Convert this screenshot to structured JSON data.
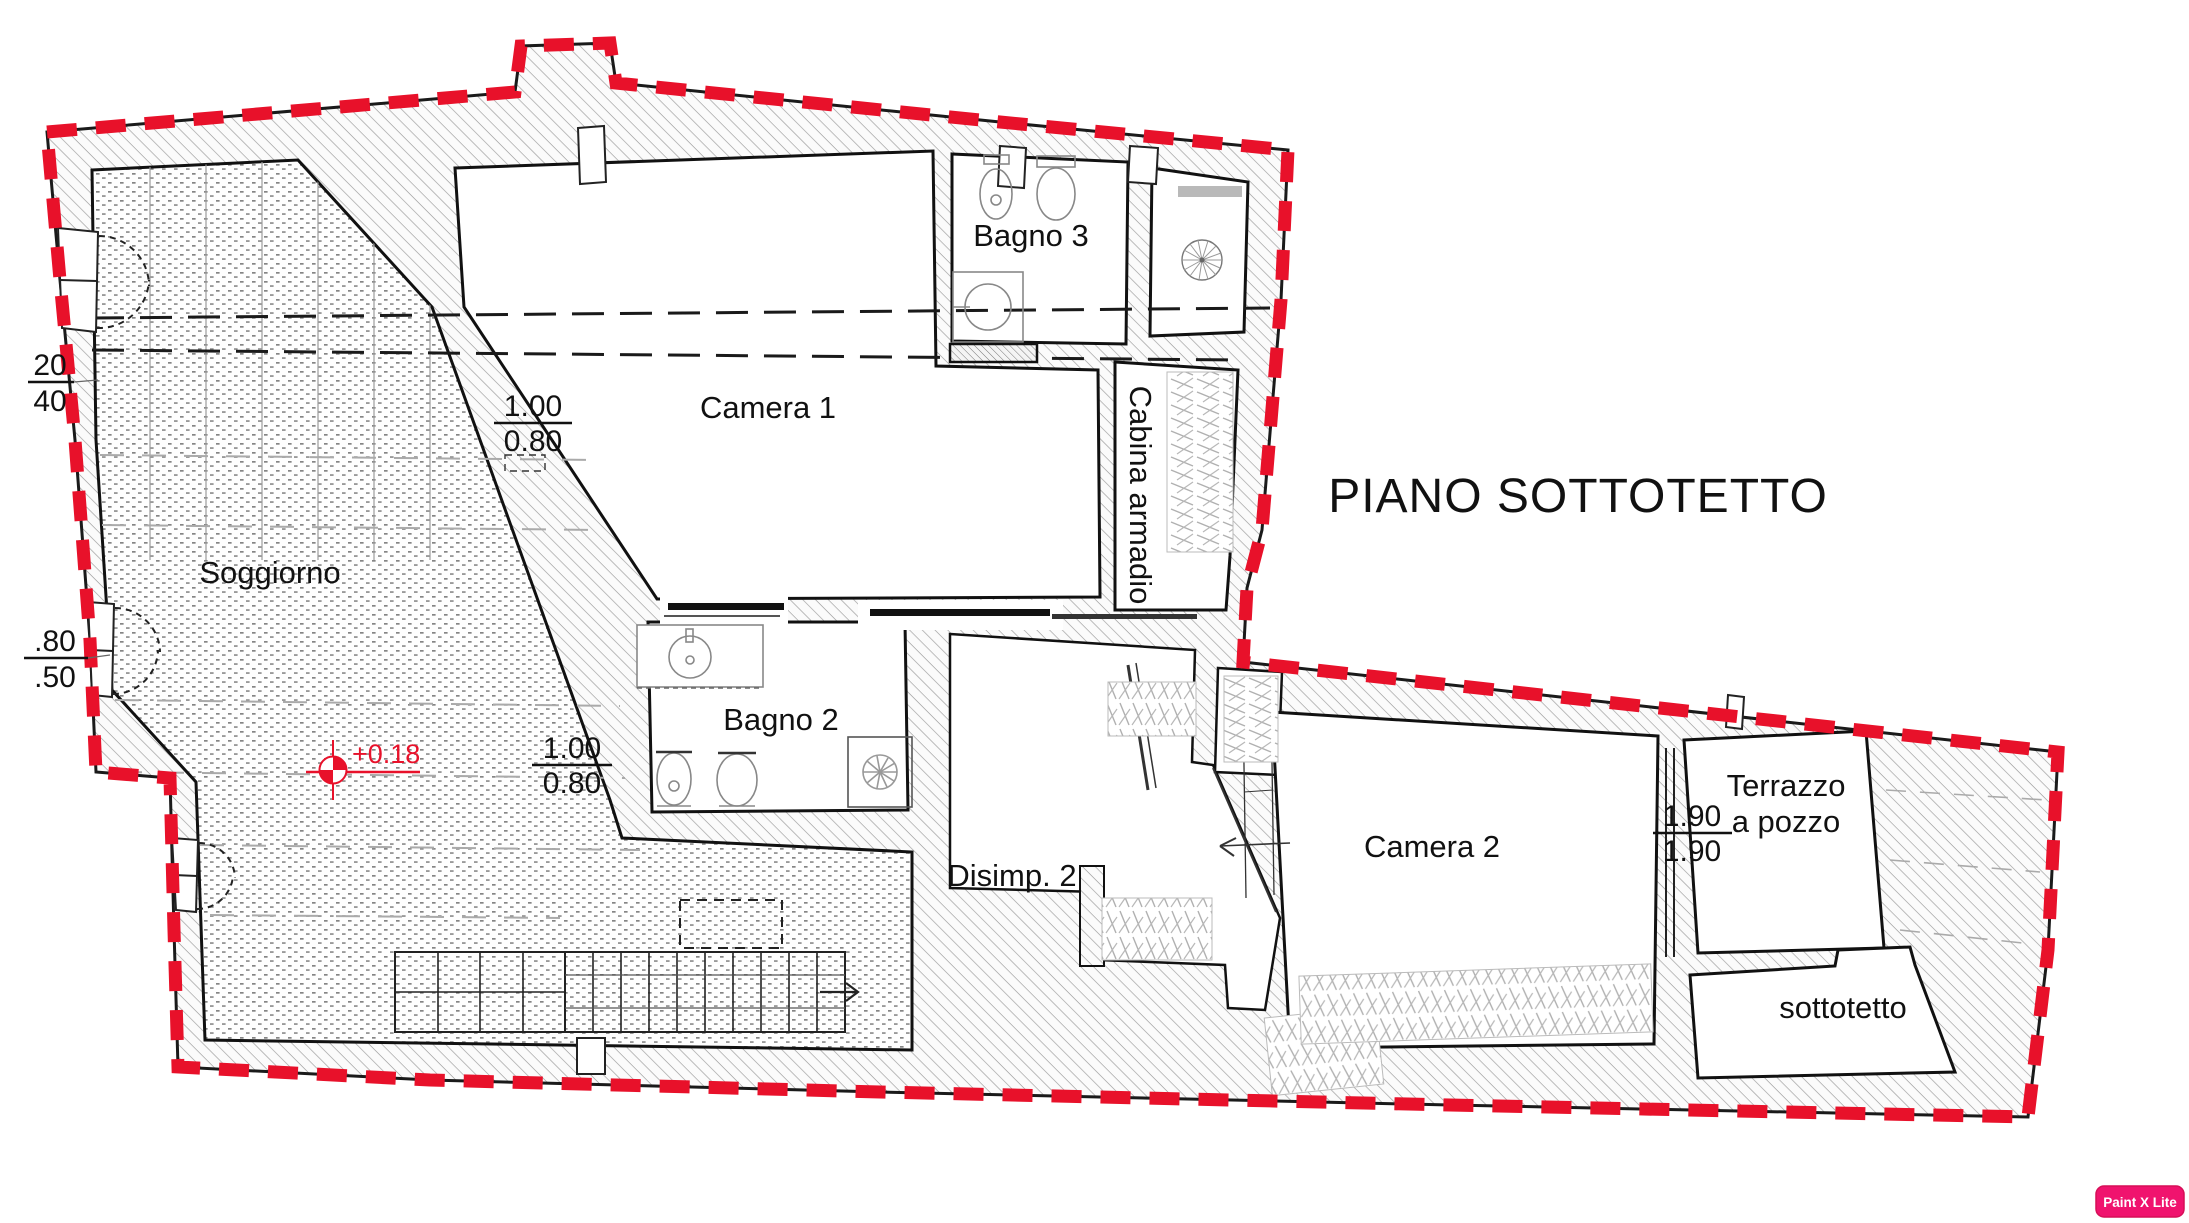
{
  "title": "PIANO SOTTOTETTO",
  "watermark": "Paint X Lite",
  "level_marker": "+0.18",
  "rooms": {
    "soggiorno": "Soggiorno",
    "camera1": "Camera 1",
    "bagno3": "Bagno 3",
    "cabina_armadio": "Cabina armadio",
    "bagno2": "Bagno 2",
    "disimp2": "Disimp. 2",
    "camera2": "Camera 2",
    "terrazzo": [
      "Terrazzo",
      "a pozzo"
    ],
    "sottotetto": "sottotetto"
  },
  "dimensions": {
    "soggiorno_window_top": {
      "num": "20",
      "den": "40"
    },
    "soggiorno_window_mid": {
      "num": ".80",
      "den": ".50"
    },
    "camera1_opening": {
      "num": "1.00",
      "den": "0.80"
    },
    "bagno2_opening": {
      "num": "1.00",
      "den": "0.80"
    },
    "terrazzo_window": {
      "num": "1.90",
      "den": "1.90"
    }
  },
  "colors": {
    "boundary": "#e8112a",
    "watermark_bg": "#f0136e",
    "ink": "#111111"
  }
}
